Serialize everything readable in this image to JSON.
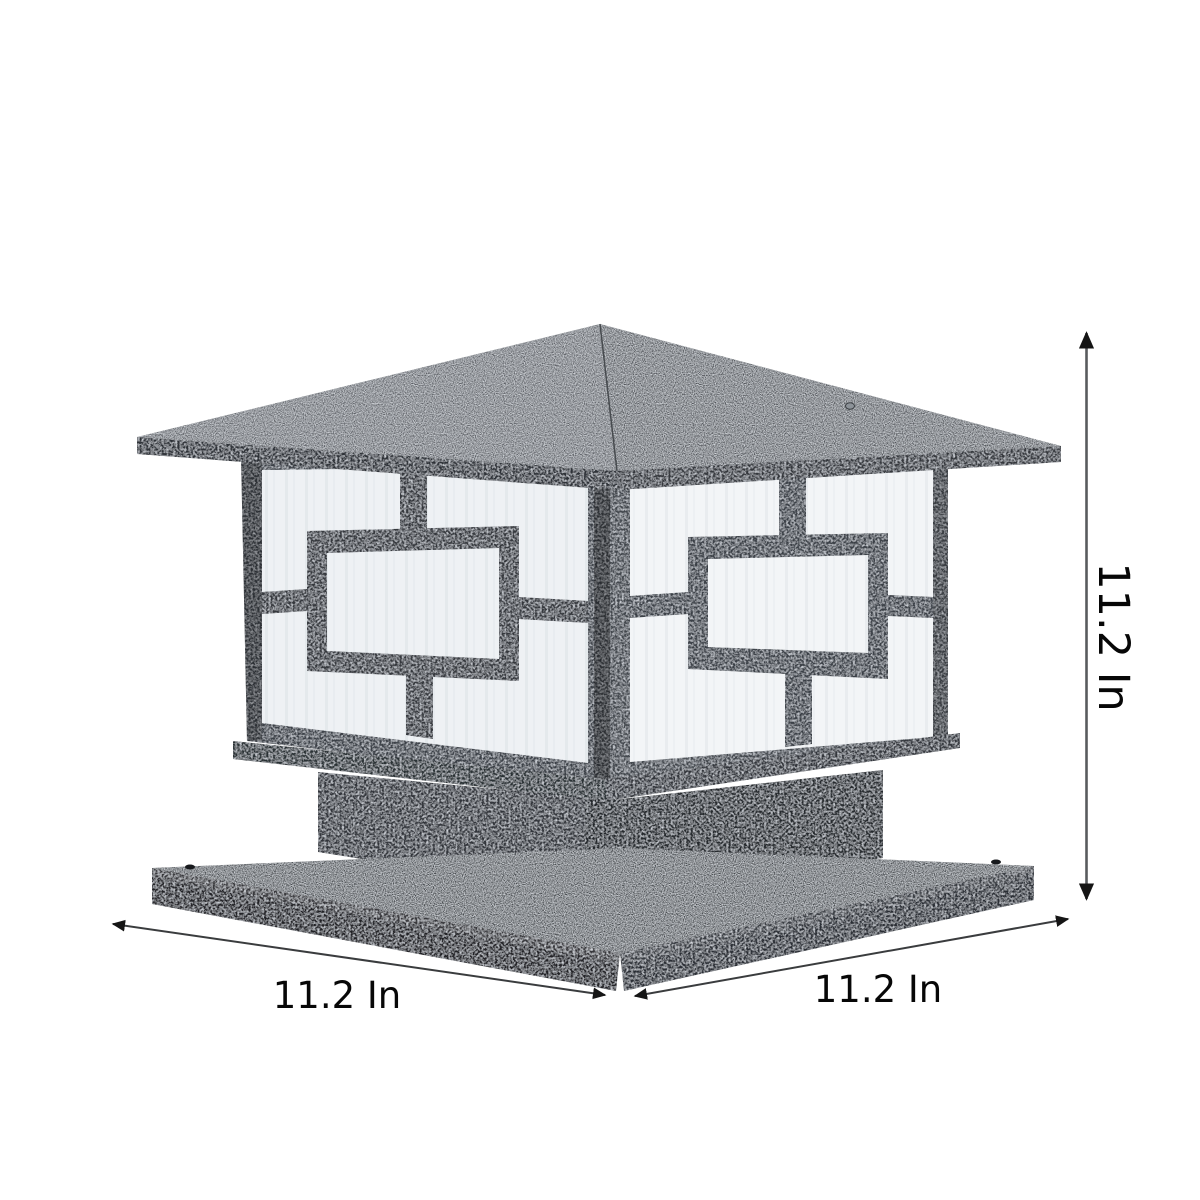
{
  "figure": {
    "type": "product-dimension-diagram",
    "subject": "pillar-post-lantern",
    "background": "#ffffff"
  },
  "dimensions": {
    "height": {
      "label": "11.2 In",
      "orientation": "vertical-right"
    },
    "width": {
      "label": "11.2 In",
      "orientation": "diagonal-bottom-left"
    },
    "depth": {
      "label": "11.2 In",
      "orientation": "diagonal-bottom-right"
    }
  },
  "colors": {
    "roof": "#5d6166",
    "roof_right": "#53575c",
    "fascia": "#2f3337",
    "fascia_right": "#34383d",
    "frame": "#3b4046",
    "frame_right": "#42474d",
    "lattice": "#34383e",
    "lattice_right": "#3b4046",
    "panel_left": "#eef1f4",
    "panel_right": "#f3f5f7",
    "rim": "#2c3034",
    "rim_right": "#32363b",
    "neck_left": "#32363b",
    "neck_right": "#26292d",
    "base_top": "#45494e",
    "base_side_left": "#212428",
    "base_side_right": "#2b2f34",
    "screw": "#8d9399",
    "dim_line": "#3a3c3e",
    "dim_line_vertical": "#595b5e",
    "dim_text": "#070707"
  }
}
